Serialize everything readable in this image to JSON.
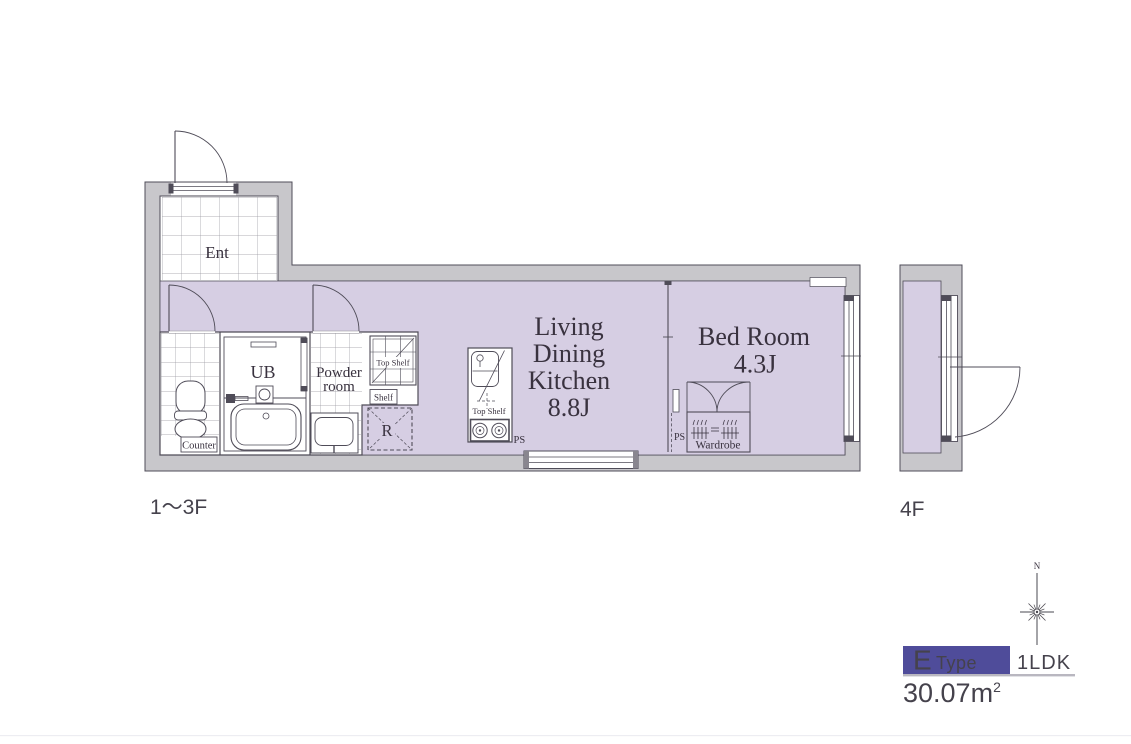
{
  "floorplan": {
    "floor_label_left": "1〜3F",
    "floor_label_right": "4F",
    "entrance": {
      "label": "Ent"
    },
    "bathroom": {
      "label": "UB"
    },
    "toilet": {
      "counter_label": "Counter"
    },
    "powder_room": {
      "line1": "Powder",
      "line2": "room",
      "top_shelf": "Top Shelf",
      "shelf": "Shelf"
    },
    "refrigerator_label": "R",
    "kitchen": {
      "top_shelf": "Top Shelf",
      "pipe_space": "PS"
    },
    "ldk": {
      "lines": [
        "Living",
        "Dining",
        "Kitchen"
      ],
      "size": "8.8J"
    },
    "bedroom": {
      "name": "Bed Room",
      "size": "4.3J",
      "pipe_space": "PS",
      "wardrobe": "Wardrobe"
    }
  },
  "compass": {
    "north": "N"
  },
  "legend": {
    "type_letter": "E",
    "type_word": "Type",
    "layout": "1LDK",
    "area_value": "30.07m",
    "area_sup": "2"
  },
  "colors": {
    "floor_lavender": "#d6cee3",
    "wall_gray": "#c8c7cb",
    "line_dark": "#4f4c58",
    "accent_indigo": "#4f4c9a",
    "text_dark": "#39323f"
  }
}
